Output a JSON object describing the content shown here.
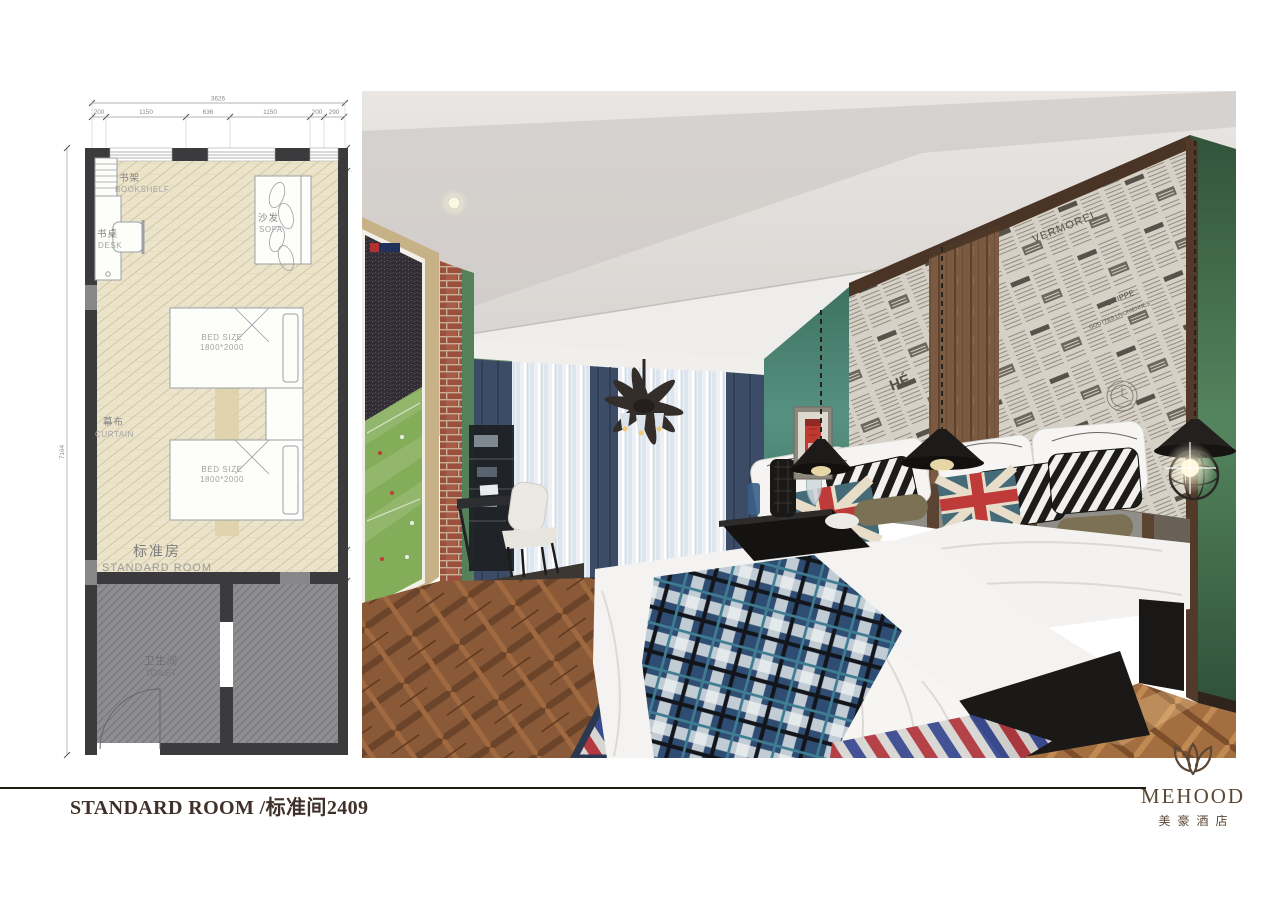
{
  "document": {
    "title": "STANDARD ROOM /标准间2409"
  },
  "brand": {
    "name": "MEHOOD",
    "chinese_name": "美豪酒店"
  },
  "floor_plan": {
    "dimensions": {
      "overall_width": "3626",
      "width_segments": [
        "200",
        "1150",
        "636",
        "1150",
        "200",
        "290"
      ],
      "overall_height": "7164",
      "right_segments": [
        "300",
        "5424",
        "440"
      ]
    },
    "rooms": {
      "standard_room_cn": "标准房",
      "standard_room_en": "STANDARD ROOM",
      "toilet_cn": "卫生间",
      "toilet_en": "TOILET"
    },
    "furniture": {
      "bookshelf_cn": "书架",
      "bookshelf_en": "BOOKSHELF",
      "desk_cn": "书桌",
      "desk_en": "DESK",
      "sofa_cn": "沙发",
      "sofa_en": "SOFA",
      "curtain_cn": "幕布",
      "curtain_en": "CURTAIN",
      "bed_size_line1": "BED SIZE",
      "bed_size_line2": "1800*2000"
    }
  },
  "photo": {
    "newspaper_words": [
      "VERMOREL",
      "GRIPPE",
      "GOUTTES LIVONIENNES",
      "HÉ"
    ]
  },
  "colors": {
    "wall_green": "#5b8a60",
    "teal_wall": "#4d8871",
    "brand_brown": "#5b4733",
    "rug_red": "#b23940",
    "rug_blue": "#3a4a90",
    "plaid_blue": "#2f4d72",
    "plan_wall": "#3b3b3d"
  }
}
